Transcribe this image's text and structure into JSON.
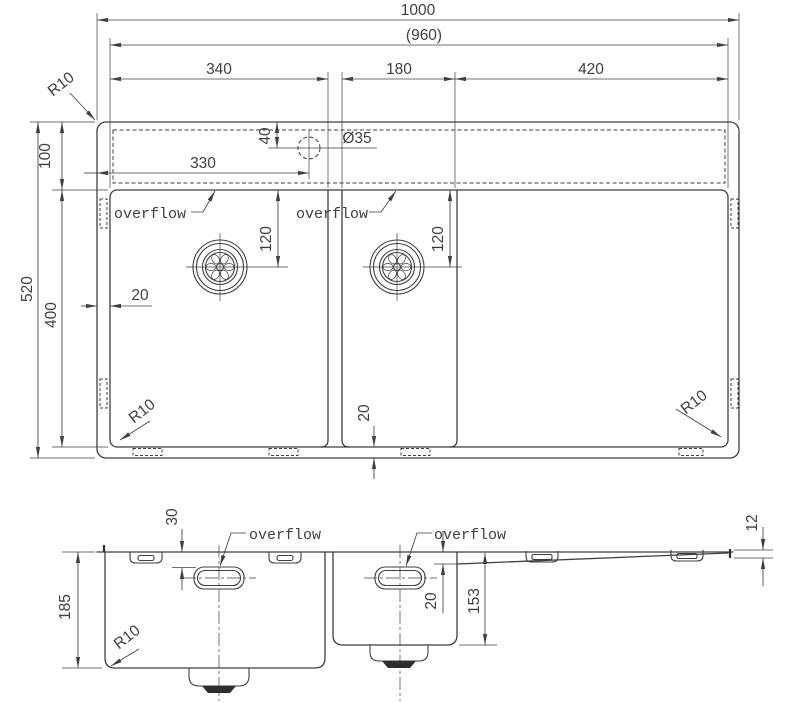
{
  "colors": {
    "line": "#3f3f3f",
    "text": "#3f3f3f",
    "background": "#ffffff",
    "drain_fill": "#2e2e2e"
  },
  "plan": {
    "overall_width": "1000",
    "usable_width": "(960)",
    "bowl1_width": "340",
    "bowl2_width": "180",
    "drainboard_width": "420",
    "corner_radius": "R10",
    "rim_band_depth": "100",
    "overall_depth": "520",
    "bowl_zone_depth": "400",
    "tap_hole_offset_x": "330",
    "tap_hole_offset_y": "40",
    "tap_hole_diameter": "Ø35",
    "overflow_label": "overflow",
    "drain_offset_bowl1": "120",
    "drain_offset_bowl2": "120",
    "side_margin": "20",
    "bottom_margin": "20"
  },
  "section": {
    "bowl1_depth": "185",
    "overflow_offset": "30",
    "overflow_label": "overflow",
    "step_depth": "20",
    "bowl2_depth": "153",
    "drainboard_edge_height": "12",
    "corner_radius": "R10"
  }
}
